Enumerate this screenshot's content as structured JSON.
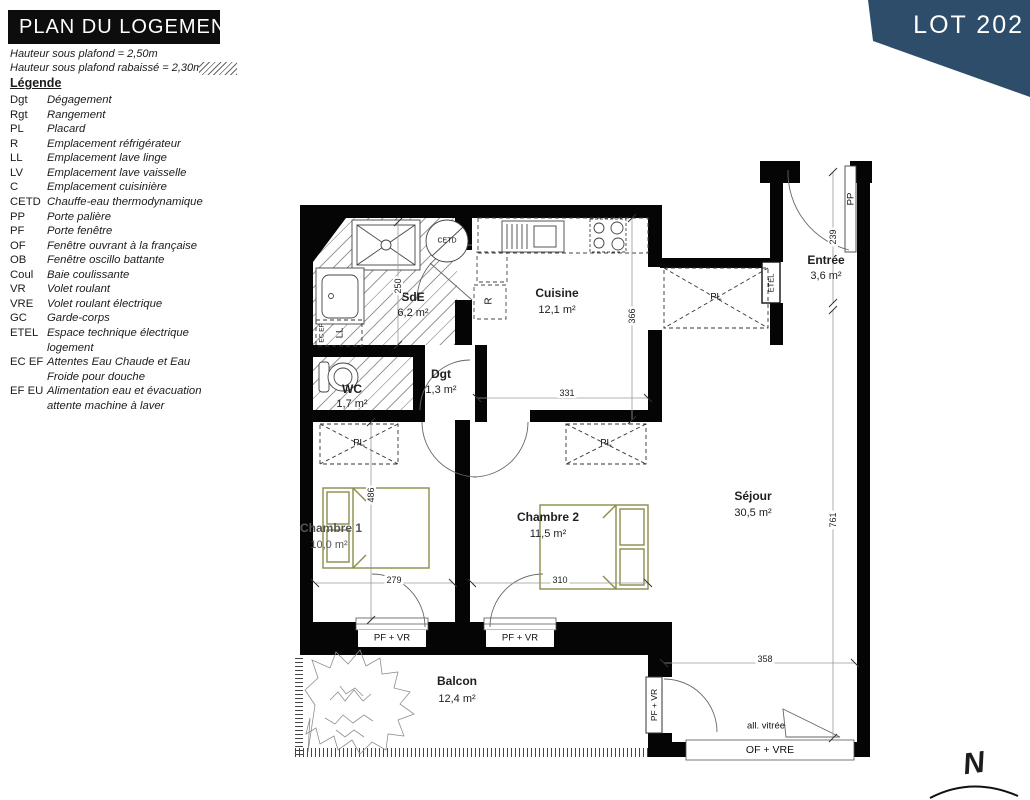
{
  "header": {
    "title": "PLAN DU LOGEMENT",
    "ceiling_note_1": "Hauteur sous plafond = 2,50m",
    "ceiling_note_2": "Hauteur sous plafond rabaissé = 2,30m"
  },
  "banner": {
    "lot_label": "LOT 202"
  },
  "legend": {
    "heading": "Légende",
    "items": [
      {
        "abbr": "Dgt",
        "desc": "Dégagement"
      },
      {
        "abbr": "Rgt",
        "desc": "Rangement"
      },
      {
        "abbr": "PL",
        "desc": "Placard"
      },
      {
        "abbr": "R",
        "desc": "Emplacement réfrigérateur"
      },
      {
        "abbr": "LL",
        "desc": "Emplacement lave linge"
      },
      {
        "abbr": "LV",
        "desc": "Emplacement lave vaisselle"
      },
      {
        "abbr": "C",
        "desc": "Emplacement cuisinière"
      },
      {
        "abbr": "CETD",
        "desc": "Chauffe-eau thermodynamique"
      },
      {
        "abbr": "PP",
        "desc": "Porte palière"
      },
      {
        "abbr": "PF",
        "desc": "Porte fenêtre"
      },
      {
        "abbr": "OF",
        "desc": "Fenêtre ouvrant à la française"
      },
      {
        "abbr": "OB",
        "desc": "Fenêtre oscillo battante"
      },
      {
        "abbr": "Coul",
        "desc": "Baie coulissante"
      },
      {
        "abbr": "VR",
        "desc": "Volet roulant"
      },
      {
        "abbr": "VRE",
        "desc": "Volet roulant électrique"
      },
      {
        "abbr": "GC",
        "desc": "Garde-corps"
      },
      {
        "abbr": "ETEL",
        "desc": "Espace technique électrique logement"
      },
      {
        "abbr": "EC EF",
        "desc": "Attentes Eau Chaude et Eau Froide pour douche"
      },
      {
        "abbr": "EF EU",
        "desc": "Alimentation eau et évacuation attente machine à laver"
      }
    ]
  },
  "plan": {
    "rooms": {
      "entree": {
        "name": "Entrée",
        "area": "3,6 m²"
      },
      "sde": {
        "name": "SdE",
        "area": "6,2 m²"
      },
      "cuisine": {
        "name": "Cuisine",
        "area": "12,1 m²"
      },
      "wc": {
        "name": "WC",
        "area": "1,7 m²"
      },
      "dgt": {
        "name": "Dgt",
        "area": "1,3 m²"
      },
      "chambre1": {
        "name": "Chambre 1",
        "area": "10,0 m²"
      },
      "chambre2": {
        "name": "Chambre 2",
        "area": "11,5 m²"
      },
      "sejour": {
        "name": "Séjour",
        "area": "30,5 m²"
      },
      "balcon": {
        "name": "Balcon",
        "area": "12,4 m²"
      }
    },
    "dimensions_cm": {
      "entree_height": "239",
      "sde_height": "250",
      "cuisine_height": "366",
      "cuisine_width": "331",
      "chambre1_height": "486",
      "chambre1_width": "279",
      "chambre2_width": "310",
      "sejour_height": "761",
      "sejour_width": "358"
    },
    "labels": {
      "pp": "PP",
      "etel": "ETEL",
      "cetd": "CETD",
      "ll": "LL",
      "ec_ef": "EC EF",
      "r": "R",
      "pl": "PL",
      "pf_vr": "PF + VR",
      "of_vre": "OF + VRE",
      "all_vitree": "all. vitrée",
      "north": "N"
    }
  },
  "colors": {
    "banner_navy": "#2e4d6b",
    "bed_olive": "#8b8b4a",
    "wall_black": "#050505"
  }
}
